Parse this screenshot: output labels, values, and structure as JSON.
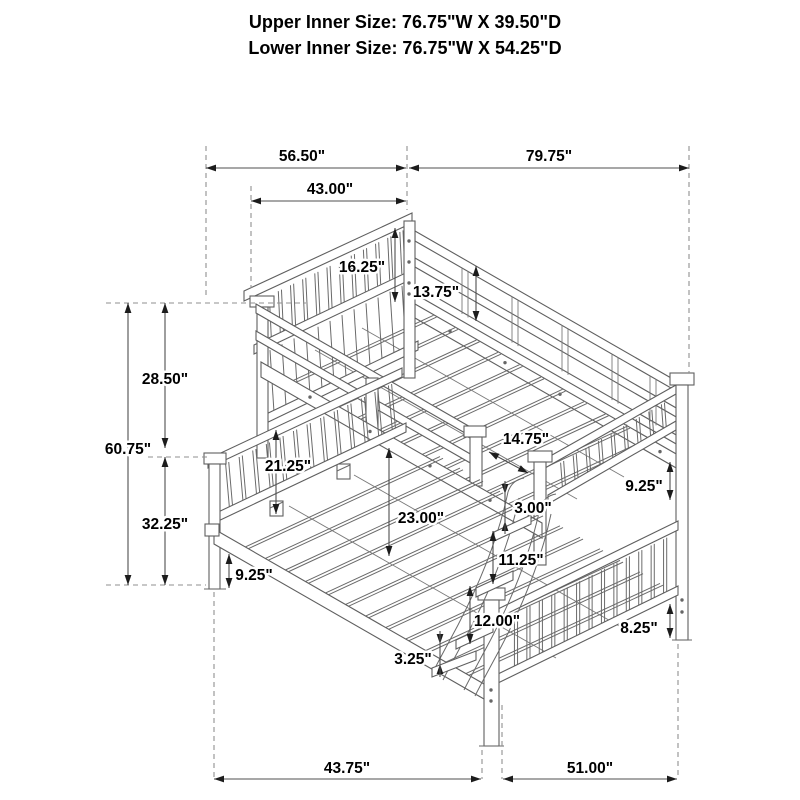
{
  "title": {
    "line1": "Upper Inner Size: 76.75\"W X 39.50\"D",
    "line2": "Lower Inner Size: 76.75\"W X 54.25\"D"
  },
  "dimensions": {
    "top_width_left": "56.50\"",
    "top_width_right": "79.75\"",
    "upper_bunk_width": "43.00\"",
    "upper_headboard_height": "16.25\"",
    "upper_footboard_rail_height": "13.75\"",
    "upper_section_height": "28.50\"",
    "overall_height": "60.75\"",
    "lower_section_height": "32.25\"",
    "lower_headboard_above_deck": "21.25\"",
    "bunk_depth_difference": "14.75\"",
    "bunk_clearance": "23.00\"",
    "ladder_hook_offset": "3.00\"",
    "ladder_rung_spacing": "11.25\"",
    "right_rail_height": "9.25\"",
    "left_rail_height": "9.25\"",
    "ladder_bottom_step": "12.00\"",
    "rail_thickness": "3.25\"",
    "footboard_leg_height": "8.25\"",
    "bottom_depth": "43.75\"",
    "bottom_length": "51.00\""
  }
}
